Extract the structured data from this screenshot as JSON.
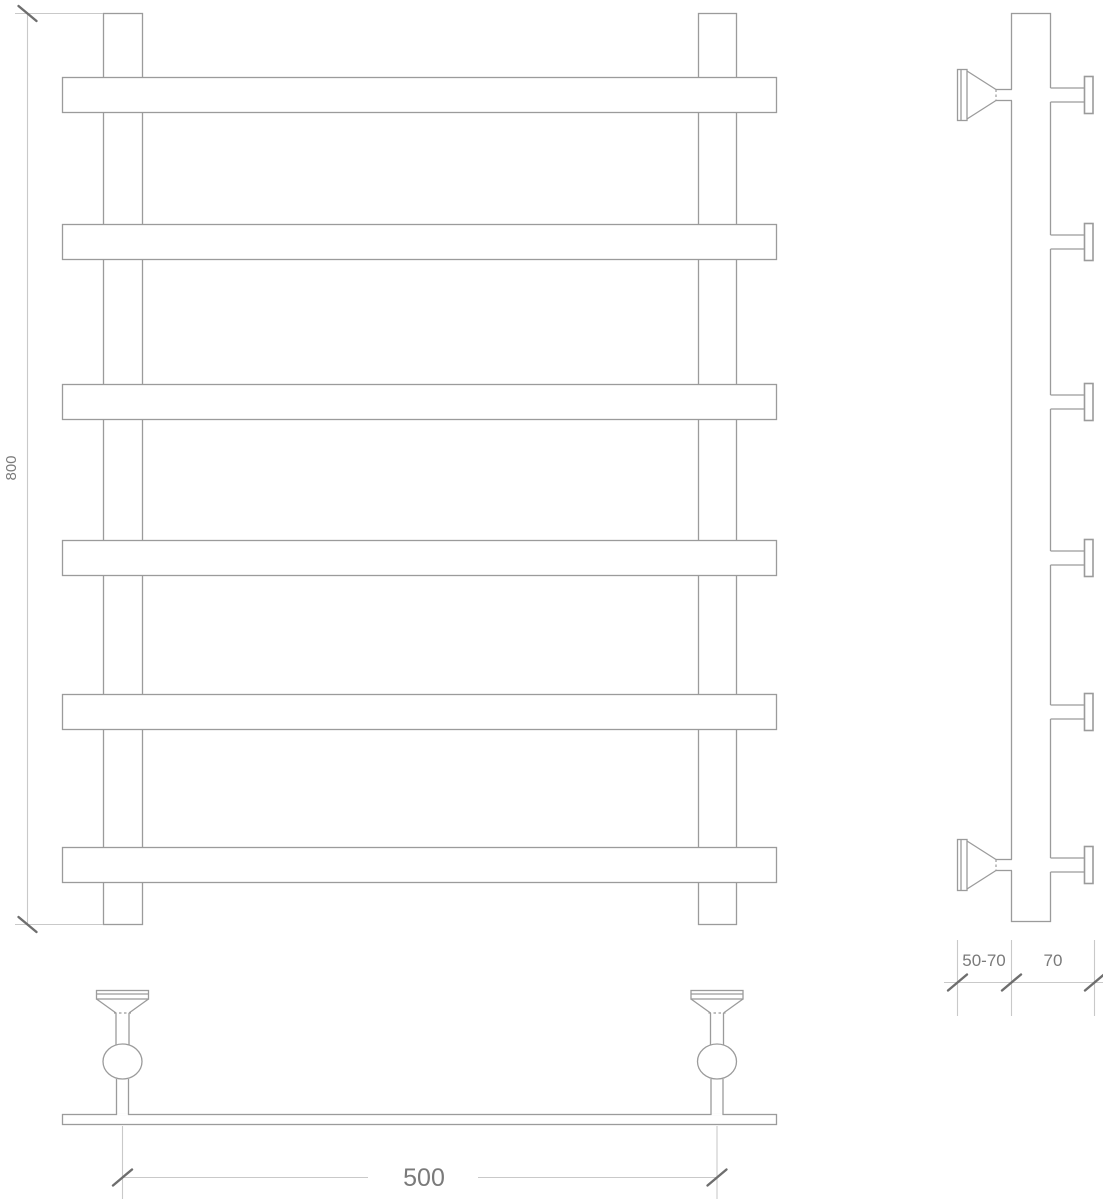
{
  "drawing": {
    "title": "towel-rail-technical-drawing",
    "views": {
      "front": {
        "bar_count": 6,
        "post_count": 2
      },
      "side": {
        "rung_count": 6,
        "wall_bracket_count": 2
      },
      "plan": {
        "bracket_count": 2
      }
    },
    "dimensions": {
      "height_label": "800",
      "width_label": "500",
      "wall_offset_label": "50-70",
      "depth_label": "70"
    },
    "colors": {
      "outline": "#9b9b9b",
      "dimension_line": "#c9c9c9",
      "tick": "#6e6e6e",
      "text": "#7a7a7a",
      "background": "#ffffff"
    }
  }
}
